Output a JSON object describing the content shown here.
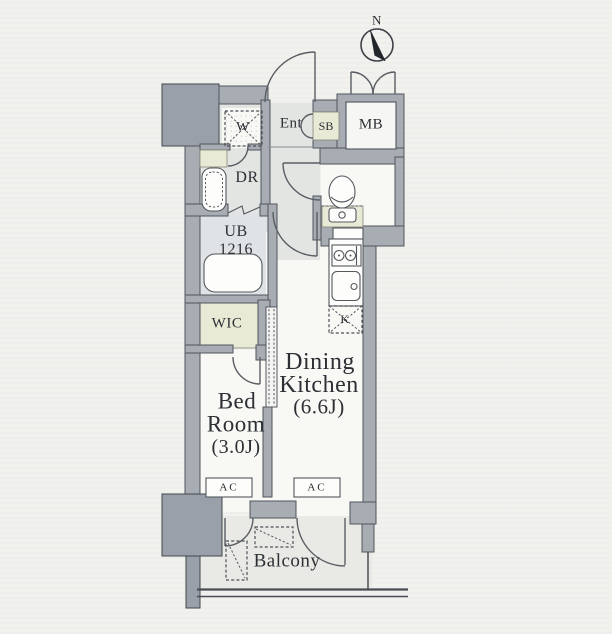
{
  "labels": {
    "compass_north": "N",
    "meter_box": "MB",
    "entrance": "Ent",
    "shoe_box": "SB",
    "washer_space": "W",
    "dressing_room": "DR",
    "unit_bath_line1": "UB",
    "unit_bath_line2": "1216",
    "walk_in_closet": "WIC",
    "bed_room_line1": "Bed",
    "bed_room_line2": "Room",
    "bed_room_size": "(3.0J)",
    "dining_kitchen_line1": "Dining",
    "dining_kitchen_line2": "Kitchen",
    "dining_kitchen_size": "(6.6J)",
    "kitchen_k": "K",
    "ac": "AC",
    "balcony": "Balcony"
  },
  "colors": {
    "paper": "#f1f1ee",
    "wall": "#a8acb3",
    "pillar": "#9aa0aa",
    "room_floor": "#f8f8f5",
    "service_floor": "#e3e5e3",
    "tatami_beige": "#e8ead6",
    "line": "#51555c"
  }
}
